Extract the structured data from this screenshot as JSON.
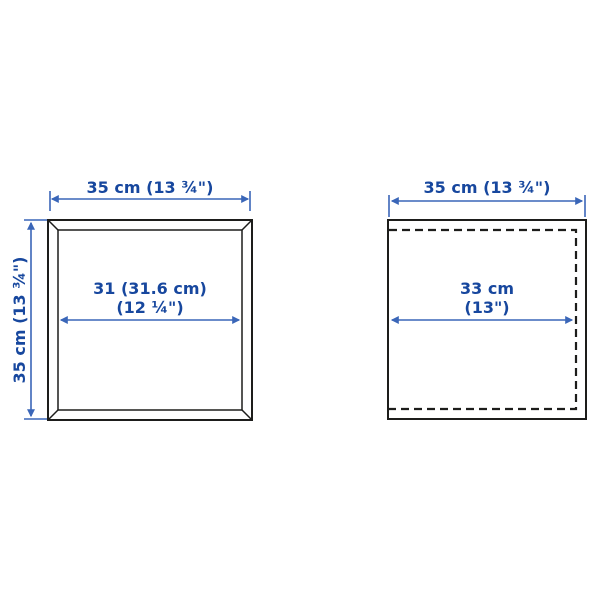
{
  "colors": {
    "label": "#17479e",
    "dimension": "#3a66b8",
    "outline": "#1d1d1b",
    "background": "#ffffff"
  },
  "left_item": {
    "width_label": "35 cm (13 ¾\")",
    "height_label": "35 cm (13 ¾\")",
    "inner_width_line1": "31 (31.6 cm)",
    "inner_width_line2": "(12 ¼\")"
  },
  "right_item": {
    "width_label": "35 cm (13 ¾\")",
    "inner_width_line1": "33 cm",
    "inner_width_line2": "(13\")"
  }
}
